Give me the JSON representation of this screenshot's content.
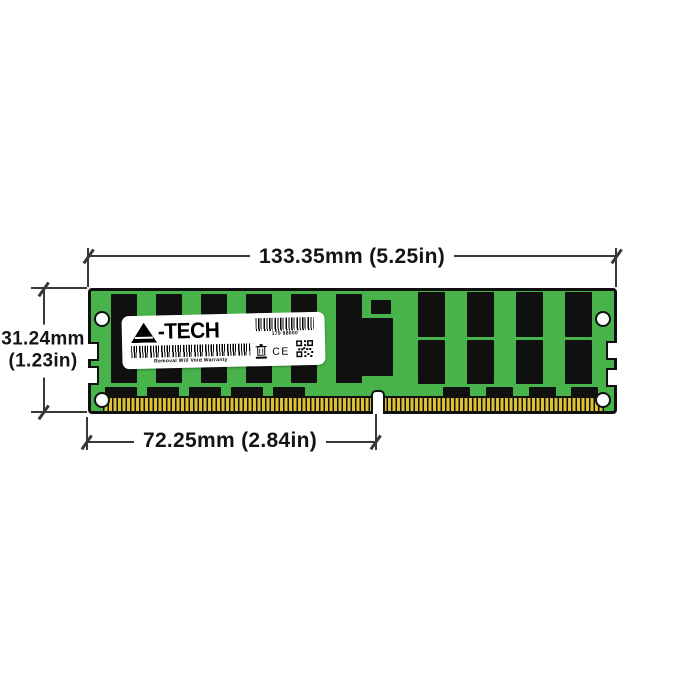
{
  "dimensions": {
    "width_label": "133.35mm (5.25in)",
    "height_label_mm": "31.24mm",
    "height_label_in": "(1.23in)",
    "notch_offset_label": "72.25mm (2.84in)"
  },
  "module": {
    "label": {
      "brand": "A-TECH",
      "brand_display_suffix": "-TECH",
      "serial_number": "179 88000",
      "warranty_text": "Removal Will Void Warranty",
      "ce_mark": "CE"
    }
  },
  "icons": {
    "logo_a": "a-tech-logo-a-icon",
    "barcode_small": "barcode-icon",
    "barcode_wide": "barcode-icon",
    "weee": "weee-crossed-bin-icon",
    "qr": "qr-code-icon"
  },
  "colors": {
    "pcb_green": "#47b34a",
    "chip_black": "#101010",
    "pin_gold": "#dcc135",
    "dimension_line": "#383838",
    "label_white": "#ffffff"
  }
}
